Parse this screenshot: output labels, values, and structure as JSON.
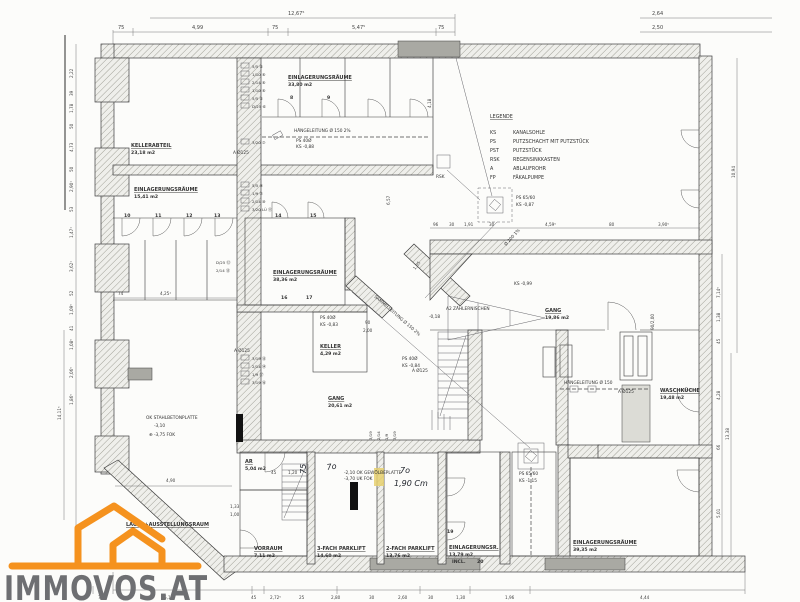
{
  "watermark": {
    "brand": "IMMOVOS.AT",
    "logo_color": "#f5921e",
    "text_color": "#6e6f72"
  },
  "legend": {
    "title": "LEGENDE",
    "entries": [
      {
        "abbr": "KS",
        "label": "KANALSOHLE"
      },
      {
        "abbr": "PS",
        "label": "PUTZSCHACHT MIT PUTZSTÜCK"
      },
      {
        "abbr": "PST",
        "label": "PUTZSTÜCK"
      },
      {
        "abbr": "RSK",
        "label": "REGENSINKKASTEN"
      },
      {
        "abbr": "A",
        "label": "ABLAUFROHR"
      },
      {
        "abbr": "FP",
        "label": "FÄKALPUMPE"
      }
    ]
  },
  "rooms": {
    "kellerabteil": {
      "name": "KELLERABTEIL",
      "area": "23,18 m2"
    },
    "einlager_3380": {
      "name": "EINLAGERUNGSRÄUME",
      "area": "33,80 m2"
    },
    "einlager_1541": {
      "name": "EINLAGERUNGSRÄUME",
      "area": "15,41 m2"
    },
    "einlager_3836": {
      "name": "EINLAGERUNGSRÄUME",
      "area": "38,36 m2"
    },
    "keller": {
      "name": "KELLER",
      "area": "4,29 m2"
    },
    "gang_2061": {
      "name": "GANG",
      "area": "20,61 m2"
    },
    "gang_1986": {
      "name": "GANG",
      "area": "19,86 m2"
    },
    "waschkueche": {
      "name": "WASCHKÜCHE",
      "area": "19,48 m2"
    },
    "ar": {
      "name": "AR",
      "area": "5,04 m2"
    },
    "vorraum": {
      "name": "VORRAUM",
      "area": "7,11 m2"
    },
    "parklift3": {
      "name": "3-FACH PARKLIFT",
      "area": "14,60 m2"
    },
    "parklift2": {
      "name": "2-FACH PARKLIFT",
      "area": "13,76 m2"
    },
    "einlager_1379": {
      "name": "EINLAGERUNGSR.",
      "area": "13,79 m2",
      "extra": "INCL."
    },
    "einlager_3935": {
      "name": "EINLAGERUNGSRÄUME",
      "area": "39,35 m2"
    },
    "lager": {
      "name": "LAGER+AUSSTELLUNGSRAUM"
    },
    "zaehler": {
      "name": "A2 ZÄHLERNISCHEN"
    }
  },
  "pipes": {
    "haenge_top": "HÄNGELEITUNG Ø 150 2%",
    "haenge_right": "HÄNGELEITUNG Ø 150",
    "sammel": "SAMMELLEITUNG Ø 150 2%",
    "abfluss": "Ø 200 1%",
    "rsk": "RSK",
    "ks099": "KS -0,99",
    "a125": "A Ø125",
    "ps40_1": {
      "l1": "PS 40Ø",
      "l2": "KS -0,88"
    },
    "ps40_2": {
      "l1": "PS 40Ø",
      "l2": "KS -0,83"
    },
    "ps40_3": {
      "l1": "PS 40Ø",
      "l2": "KS -0,84"
    },
    "ps65_1": {
      "l1": "PS 65/60",
      "l2": "KS -0,87"
    },
    "ps65_2": {
      "l1": "PS 65/60",
      "l2": "KS -1,15"
    }
  },
  "notes": {
    "plate1": "OK STAHLBETONPLATTE",
    "plate2": "-3,10",
    "plate3": "⊕ -3,75 FOK",
    "vault1": "-2,10 OK GEWÖLBEPLATTE",
    "vault2": "-3,70 UK FOK",
    "elev018": "-0,18"
  },
  "flues": {
    "a": [
      "5/5 ⑤",
      "1/10 ⑥",
      "2/14 ⑥",
      "1/10 ⑥",
      "5/5 ⑤",
      "D/25 ⑥"
    ],
    "a2": "3/20 ⑦",
    "b": [
      "5/5 ⑨",
      "1/9 ⑦",
      "2/14 ⑩",
      "3/20 LÜ ⑪"
    ],
    "c": [
      "D/25 ⑫",
      "2/14 ⑬"
    ],
    "d": [
      "3/19 ⑮",
      "2/14 ⑭",
      "1/9 ⑰",
      "3/19 ⑯"
    ],
    "e": [
      "3/19",
      "2/14",
      "1/9",
      "3/19"
    ]
  },
  "tags": {
    "numbers": [
      "8",
      "9",
      "10",
      "11",
      "12",
      "13",
      "14",
      "15",
      "16",
      "17",
      "19",
      "20"
    ],
    "door_tag": "90/2,00",
    "door_w": "90",
    "door_h": "2,00"
  },
  "handwriting": {
    "w75": "75",
    "w70a": "7o",
    "w70b": "7o",
    "w190": "1,90 Cm"
  },
  "dims": {
    "top_main": "12,67⁵",
    "top_right1": "2,64",
    "top_right2": "2,50",
    "top_row": [
      "75",
      "4,99",
      "75",
      "5,47⁵",
      "75"
    ],
    "left_col": [
      "2,22",
      "39",
      "1,78",
      "50",
      "4,73",
      "50",
      "2,90¹",
      "53",
      "1,47¹",
      "3,62¹",
      "52",
      "1,09⁵",
      "41",
      "1,08⁵",
      "2,06⁵",
      "1,86⁵"
    ],
    "left_total": "14,11⁵",
    "left_inner1": "74",
    "left_inner2": "4,25¹",
    "right_col": [
      "7,14⁵",
      "1,38",
      "45",
      "4,28",
      "66",
      "5,01"
    ],
    "right_total_upper": "10,94",
    "right_total_lower": "13,38",
    "mid_row": [
      "96",
      "30",
      "1,91",
      "30",
      "4,59⁵",
      "80",
      "3,90⁵"
    ],
    "bottom_row": [
      "75",
      "5,15",
      "45",
      "2,72⁵",
      "25",
      "2,80",
      "30",
      "2,60",
      "30",
      "1,30",
      "1,96",
      "4,44"
    ],
    "v418": "4,18",
    "v657": "6,57",
    "v105": "1,05",
    "lager_w": "4,90",
    "s133": "1,33",
    "s100": "1,00",
    "ar_45": "45",
    "ar_120": "1,20"
  }
}
